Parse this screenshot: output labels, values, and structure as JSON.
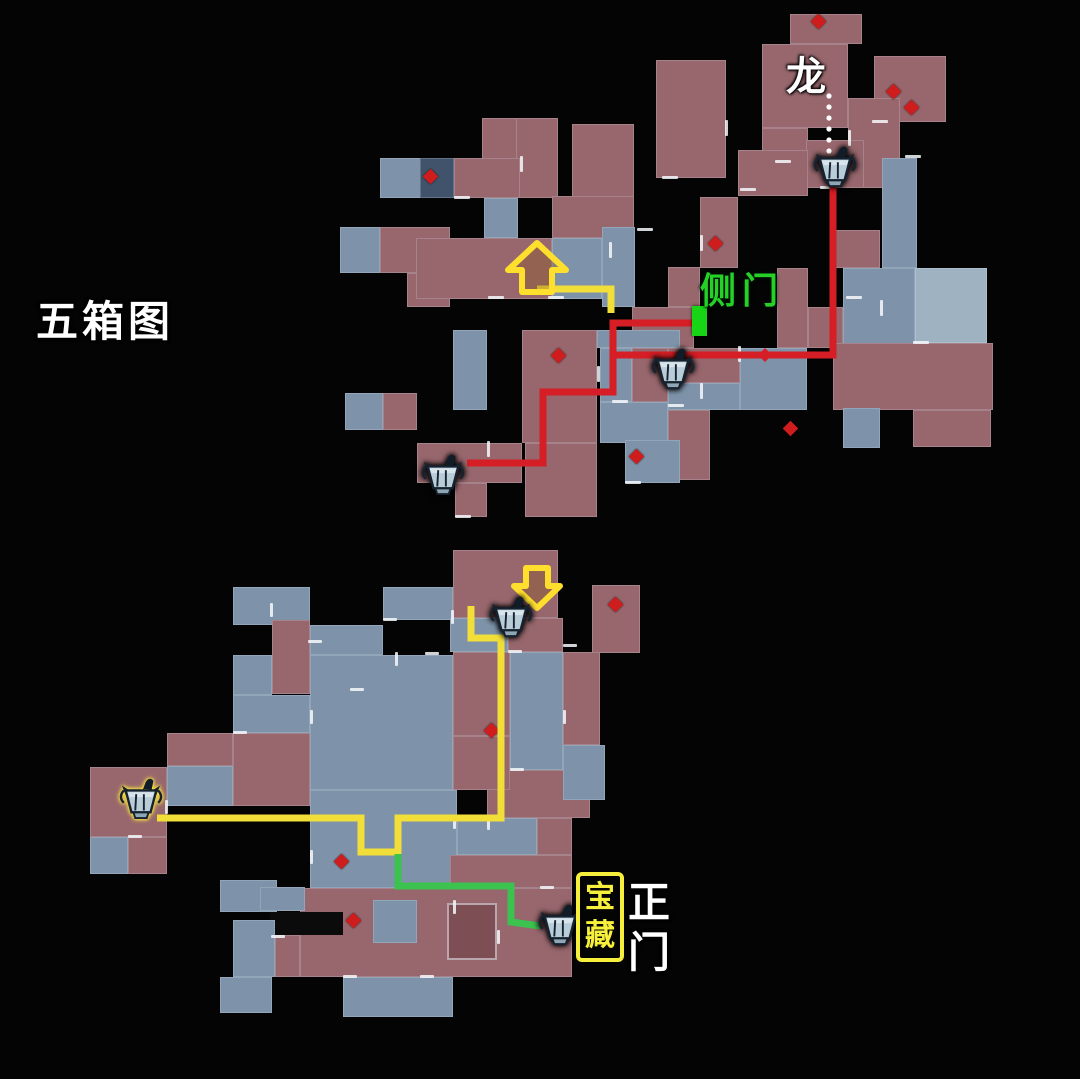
{
  "labels": {
    "map_title": "五箱图",
    "dragon": "龙",
    "side_door": "侧门",
    "treasure_chars": [
      "宝",
      "藏"
    ],
    "main_gate_chars": [
      "正",
      "门"
    ]
  },
  "colors": {
    "room_red": "#97676d",
    "room_blue": "#7e93a9",
    "route_red": "#d51e25",
    "route_yellow": "#f2de39",
    "route_green": "#3cc24f",
    "door_marker_green": "#17d417",
    "treasure_box_yellow": "#f6ef3b",
    "diamond_red": "#cf1d1d",
    "background": "#040404"
  },
  "maps": {
    "top": {
      "rooms": [
        [
          790,
          14,
          72,
          30,
          "r"
        ],
        [
          762,
          44,
          86,
          84,
          "r"
        ],
        [
          874,
          56,
          72,
          66,
          "r"
        ],
        [
          848,
          98,
          52,
          90,
          "r"
        ],
        [
          762,
          128,
          46,
          60,
          "r"
        ],
        [
          806,
          140,
          58,
          48,
          "r"
        ],
        [
          738,
          150,
          70,
          46,
          "r"
        ],
        [
          656,
          60,
          70,
          118,
          "r"
        ],
        [
          572,
          124,
          62,
          104,
          "r"
        ],
        [
          482,
          118,
          42,
          44,
          "r"
        ],
        [
          516,
          118,
          42,
          80,
          "r"
        ],
        [
          454,
          158,
          66,
          40,
          "r"
        ],
        [
          380,
          158,
          42,
          40,
          "b"
        ],
        [
          420,
          158,
          34,
          40,
          "d"
        ],
        [
          340,
          227,
          40,
          46,
          "b"
        ],
        [
          380,
          227,
          70,
          46,
          "r"
        ],
        [
          407,
          273,
          43,
          34,
          "r"
        ],
        [
          484,
          198,
          34,
          40,
          "b"
        ],
        [
          416,
          238,
          136,
          61,
          "r"
        ],
        [
          552,
          196,
          82,
          42,
          "r"
        ],
        [
          552,
          238,
          50,
          61,
          "b"
        ],
        [
          602,
          227,
          33,
          80,
          "b"
        ],
        [
          668,
          267,
          32,
          40,
          "r"
        ],
        [
          700,
          197,
          38,
          71,
          "r"
        ],
        [
          632,
          307,
          62,
          41,
          "r"
        ],
        [
          777,
          268,
          31,
          80,
          "r"
        ],
        [
          808,
          307,
          35,
          41,
          "r"
        ],
        [
          843,
          268,
          72,
          80,
          "b"
        ],
        [
          882,
          158,
          35,
          110,
          "b"
        ],
        [
          835,
          230,
          45,
          38,
          "r"
        ],
        [
          915,
          268,
          72,
          75,
          "lb"
        ],
        [
          833,
          343,
          160,
          67,
          "r"
        ],
        [
          913,
          410,
          78,
          37,
          "r"
        ],
        [
          843,
          408,
          37,
          40,
          "b"
        ],
        [
          597,
          330,
          83,
          18,
          "b"
        ],
        [
          600,
          348,
          32,
          54,
          "b"
        ],
        [
          632,
          348,
          36,
          54,
          "r"
        ],
        [
          668,
          348,
          72,
          35,
          "r"
        ],
        [
          668,
          383,
          72,
          27,
          "b"
        ],
        [
          740,
          348,
          67,
          62,
          "b"
        ],
        [
          600,
          402,
          68,
          41,
          "b"
        ],
        [
          668,
          410,
          42,
          70,
          "r"
        ],
        [
          453,
          330,
          34,
          80,
          "b"
        ],
        [
          522,
          330,
          75,
          113,
          "r"
        ],
        [
          417,
          443,
          105,
          40,
          "r"
        ],
        [
          455,
          483,
          32,
          34,
          "r"
        ],
        [
          525,
          443,
          72,
          74,
          "r"
        ],
        [
          625,
          440,
          55,
          43,
          "b"
        ],
        [
          345,
          393,
          38,
          37,
          "b"
        ],
        [
          383,
          393,
          34,
          37,
          "r"
        ]
      ],
      "diamonds": [
        [
          818,
          21
        ],
        [
          893,
          91
        ],
        [
          911,
          107
        ],
        [
          715,
          243
        ],
        [
          558,
          355
        ],
        [
          790,
          428
        ],
        [
          636,
          456
        ],
        [
          430,
          176
        ]
      ],
      "ticks": [
        [
          609,
          242,
          3,
          16
        ],
        [
          637,
          228,
          16,
          3
        ],
        [
          662,
          176,
          16,
          3
        ],
        [
          700,
          235,
          3,
          16
        ],
        [
          725,
          120,
          3,
          16
        ],
        [
          740,
          188,
          16,
          3
        ],
        [
          775,
          160,
          16,
          3
        ],
        [
          820,
          186,
          16,
          3
        ],
        [
          848,
          130,
          3,
          16
        ],
        [
          872,
          120,
          16,
          3
        ],
        [
          905,
          155,
          16,
          3
        ],
        [
          846,
          296,
          16,
          3
        ],
        [
          880,
          300,
          3,
          16
        ],
        [
          913,
          341,
          16,
          3
        ],
        [
          738,
          346,
          3,
          16
        ],
        [
          700,
          383,
          3,
          16
        ],
        [
          668,
          404,
          16,
          3
        ],
        [
          612,
          400,
          16,
          3
        ],
        [
          548,
          296,
          16,
          3
        ],
        [
          488,
          296,
          16,
          3
        ],
        [
          454,
          196,
          16,
          3
        ],
        [
          520,
          156,
          3,
          16
        ],
        [
          552,
          276,
          3,
          16
        ],
        [
          597,
          366,
          3,
          16
        ],
        [
          625,
          481,
          16,
          3
        ],
        [
          487,
          441,
          3,
          16
        ],
        [
          540,
          420,
          3,
          16
        ],
        [
          455,
          515,
          16,
          3
        ]
      ],
      "routes": [
        {
          "name": "red-route-a",
          "color": "#d51e25",
          "width": 7,
          "points": [
            [
              833,
              180
            ],
            [
              833,
              355
            ],
            [
              613,
              355
            ],
            [
              613,
              323
            ],
            [
              701,
              323
            ]
          ]
        },
        {
          "name": "red-route-b",
          "color": "#d51e25",
          "width": 7,
          "points": [
            [
              613,
              355
            ],
            [
              613,
              392
            ],
            [
              543,
              392
            ],
            [
              543,
              463
            ],
            [
              467,
              463
            ]
          ]
        },
        {
          "name": "yellow-route-top",
          "color": "#f2de39",
          "width": 7,
          "points": [
            [
              537,
              289
            ],
            [
              611,
              289
            ],
            [
              611,
              313
            ]
          ]
        }
      ],
      "route_arrowhead": {
        "x": 765,
        "y": 355,
        "size": 14,
        "color": "#d51e25"
      },
      "dots": {
        "x": 829,
        "ys": [
          96,
          107,
          118,
          129,
          140,
          151
        ],
        "r": 2.6,
        "color": "#ffffff"
      },
      "up_arrow": {
        "points": "537,243 508,270 522,270 522,292 552,292 552,270 566,270",
        "stroke": "#ffdf2e",
        "fill": "rgba(140,90,30,0.35)"
      },
      "chests": [
        [
          812,
          146
        ],
        [
          650,
          348
        ],
        [
          420,
          454
        ]
      ]
    },
    "bottom": {
      "rooms": [
        [
          453,
          550,
          105,
          68,
          "r"
        ],
        [
          592,
          585,
          48,
          68,
          "r"
        ],
        [
          383,
          587,
          70,
          33,
          "b"
        ],
        [
          233,
          587,
          77,
          38,
          "b"
        ],
        [
          450,
          618,
          58,
          34,
          "b"
        ],
        [
          508,
          618,
          55,
          34,
          "r"
        ],
        [
          453,
          652,
          57,
          84,
          "r"
        ],
        [
          510,
          652,
          53,
          118,
          "b"
        ],
        [
          563,
          652,
          37,
          93,
          "r"
        ],
        [
          272,
          620,
          38,
          74,
          "r"
        ],
        [
          310,
          625,
          73,
          30,
          "b"
        ],
        [
          233,
          655,
          39,
          40,
          "b"
        ],
        [
          310,
          655,
          143,
          135,
          "b"
        ],
        [
          167,
          733,
          66,
          33,
          "r"
        ],
        [
          167,
          766,
          66,
          40,
          "b"
        ],
        [
          90,
          767,
          77,
          70,
          "r"
        ],
        [
          90,
          837,
          38,
          37,
          "b"
        ],
        [
          128,
          837,
          39,
          37,
          "r"
        ],
        [
          233,
          695,
          77,
          38,
          "b"
        ],
        [
          233,
          733,
          77,
          73,
          "r"
        ],
        [
          310,
          790,
          147,
          98,
          "b"
        ],
        [
          487,
          770,
          103,
          48,
          "r"
        ],
        [
          457,
          818,
          80,
          37,
          "b"
        ],
        [
          537,
          818,
          35,
          37,
          "r"
        ],
        [
          453,
          736,
          57,
          54,
          "r"
        ],
        [
          563,
          745,
          42,
          55,
          "b"
        ],
        [
          450,
          855,
          122,
          33,
          "r"
        ],
        [
          300,
          888,
          272,
          89,
          "r"
        ],
        [
          220,
          880,
          57,
          32,
          "b"
        ],
        [
          260,
          887,
          45,
          24,
          "b"
        ],
        [
          270,
          912,
          73,
          23,
          "k"
        ],
        [
          373,
          900,
          44,
          43,
          "b"
        ],
        [
          233,
          920,
          42,
          57,
          "b"
        ],
        [
          275,
          935,
          25,
          42,
          "r"
        ],
        [
          343,
          977,
          110,
          40,
          "b"
        ],
        [
          220,
          977,
          52,
          36,
          "b"
        ],
        [
          447,
          903,
          50,
          57,
          "dr"
        ]
      ],
      "diamonds": [
        [
          615,
          604
        ],
        [
          491,
          730
        ],
        [
          341,
          861
        ],
        [
          353,
          920
        ]
      ],
      "ticks": [
        [
          270,
          603,
          3,
          14
        ],
        [
          308,
          640,
          14,
          3
        ],
        [
          383,
          618,
          14,
          3
        ],
        [
          425,
          652,
          14,
          3
        ],
        [
          451,
          610,
          3,
          14
        ],
        [
          508,
          650,
          14,
          3
        ],
        [
          563,
          644,
          14,
          3
        ],
        [
          310,
          710,
          3,
          14
        ],
        [
          350,
          688,
          14,
          3
        ],
        [
          395,
          652,
          3,
          14
        ],
        [
          233,
          731,
          14,
          3
        ],
        [
          165,
          800,
          3,
          14
        ],
        [
          128,
          835,
          14,
          3
        ],
        [
          310,
          850,
          3,
          14
        ],
        [
          453,
          815,
          3,
          14
        ],
        [
          487,
          816,
          3,
          14
        ],
        [
          510,
          768,
          14,
          3
        ],
        [
          563,
          710,
          3,
          14
        ],
        [
          453,
          900,
          3,
          14
        ],
        [
          497,
          930,
          3,
          14
        ],
        [
          343,
          975,
          14,
          3
        ],
        [
          420,
          975,
          14,
          3
        ],
        [
          271,
          935,
          14,
          3
        ],
        [
          540,
          886,
          14,
          3
        ]
      ],
      "routes": [
        {
          "name": "yellow-route-bottom",
          "color": "#f2de39",
          "width": 7,
          "points": [
            [
              471,
              606
            ],
            [
              471,
              638
            ],
            [
              501,
              638
            ],
            [
              501,
              818
            ],
            [
              398,
              818
            ],
            [
              398,
              852
            ],
            [
              361,
              852
            ],
            [
              361,
              818
            ],
            [
              157,
              818
            ]
          ]
        },
        {
          "name": "green-route",
          "color": "#3cc24f",
          "width": 7,
          "points": [
            [
              398,
              854
            ],
            [
              398,
              886
            ],
            [
              511,
              886
            ],
            [
              511,
              922
            ],
            [
              540,
              926
            ]
          ]
        }
      ],
      "down_arrow": {
        "points": "526,568 548,568 548,586 560,586 537,608 514,586 526,586",
        "stroke": "#ffdf2e",
        "fill": "rgba(140,90,30,0.35)"
      },
      "chests": [
        [
          488,
          596
        ],
        [
          118,
          778
        ],
        [
          537,
          904
        ]
      ],
      "highlighted_chest_index": 1
    }
  }
}
